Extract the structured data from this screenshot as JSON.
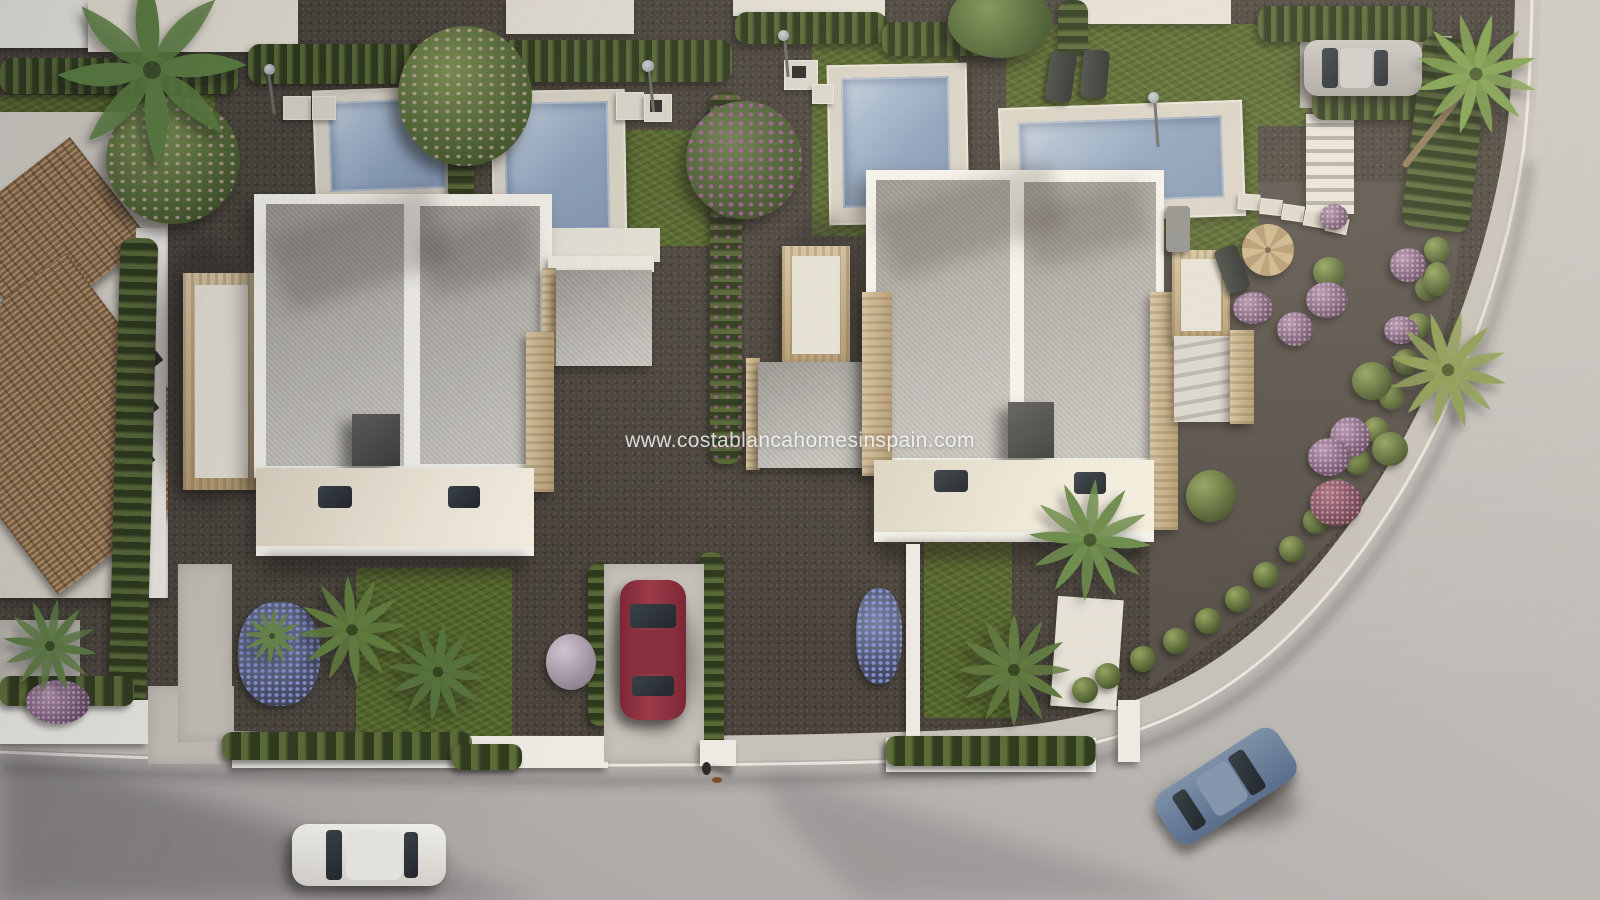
{
  "image": {
    "kind": "aerial 3D architectural render",
    "description": "bird's-eye view of a new-build development of white modern duplex villas with private pools, travertine trims, landscaped gardens and a curved residential street"
  },
  "watermark": {
    "text": "www.costablancahomesinspain.com"
  },
  "palette": {
    "gravel": "#4a443c",
    "road": "#b6b2ae",
    "road_light": "#cbc7c3",
    "sidewalk": "#c6c1ba",
    "curb": "#efebe2",
    "grass": "#56672e",
    "hedge": "#3c4927",
    "pool_water": "#8ca1bc",
    "pool_deck": "#d9d3c6",
    "villa_white": "#f4f2eb",
    "roof_grey": "#b2afaa",
    "travertine": "#c4ad85",
    "terracotta": "#9a7a54",
    "bougainvillea": "#a85fa8",
    "car_white": "#e8e6e2",
    "car_red": "#8e3140",
    "car_blue": "#6b7f99",
    "car_silver": "#b9b6b2"
  },
  "scene": {
    "buildings": [
      {
        "name": "left duplex villa",
        "features": "flat grey twin roof panels, white parapets, travertine pergola, cream ground-floor canopy with skylights"
      },
      {
        "name": "right duplex villa",
        "features": "flat grey twin roof panels, white parapets, travertine columns, side terrace and external stair"
      },
      {
        "name": "existing house with terracotta tiled roofs",
        "position": "left edge"
      },
      {
        "name": "neighbouring villas",
        "position": "along top edge"
      }
    ],
    "pools": [
      {
        "location": "top-left corner, partially visible"
      },
      {
        "location": "behind left villa, west half"
      },
      {
        "location": "behind left villa, east half"
      },
      {
        "location": "behind right villa, west half"
      },
      {
        "location": "behind right villa, east half, wide deck"
      }
    ],
    "vehicles": [
      {
        "type": "car",
        "color": "white",
        "state": "driving on road",
        "location": "bottom-left"
      },
      {
        "type": "car",
        "color": "dark red",
        "state": "parked in driveway",
        "location": "center front of left villa"
      },
      {
        "type": "car",
        "color": "steel blue",
        "state": "driving on curve",
        "location": "bottom-right"
      },
      {
        "type": "car",
        "color": "silver grey",
        "state": "parked on pad",
        "location": "top-right"
      }
    ],
    "person": {
      "description": "pedestrian with small dog at road edge",
      "location": "bottom-center"
    },
    "landscaping": [
      "cypress hedges",
      "fan palms",
      "banana plant",
      "bougainvillea hedge and trees",
      "flowering trees",
      "lavender ball shrub",
      "purple flowering shrubs",
      "lawns",
      "gravel beds"
    ],
    "furniture": [
      "two dark sun loungers",
      "tan parasol with deck chair",
      "grey outdoor sofa",
      "outdoor shower pads",
      "street lamps"
    ],
    "hardscape": [
      "stone pool decks",
      "stepping stones",
      "white staircase",
      "white boundary walls",
      "concrete driveways",
      "sidewalk with white curb"
    ]
  }
}
